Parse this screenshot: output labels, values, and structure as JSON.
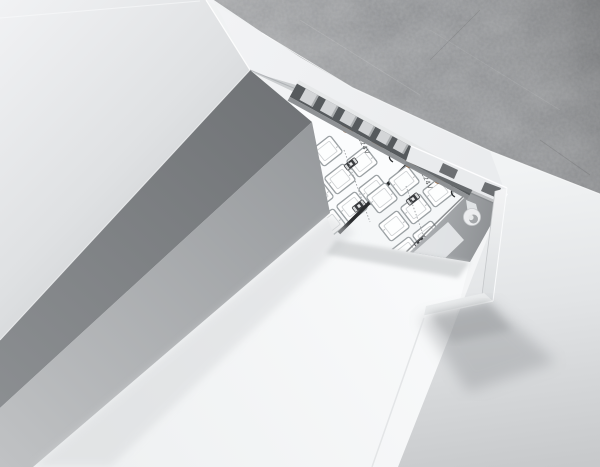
{
  "image": {
    "subject": "Recessed aluminum LED profile with two LED strips, ceiling cutaway render"
  },
  "labels": {
    "strip_voltage": "DC24V",
    "polarity_plus": "+"
  },
  "colors": {
    "concrete": "#85878a",
    "ceiling_light": "#eff1f3",
    "groove_dark_side": "#76797c",
    "profile_outer_side": "#a0a3a6",
    "opening_back": "#cbced0",
    "tooth_light": "#d3d5d7",
    "tooth_gap_dark": "#565a5d",
    "pcb_white": "#fbfcfd",
    "pcb_white_2": "#f5f7f8",
    "copper_pad": "#b4763c",
    "resistor_body": "#3b3d40",
    "resistor_band": "#d8dadb",
    "strip_gap_line": "#2a2c2e",
    "led_outline": "#9aa0a3",
    "cut_face": "#e9ebed",
    "cut_slot_dark": "#6c6f72",
    "cavity_gray": "#a9acaf",
    "diffuser_inner": "#e4e6e8",
    "print_text": "#55585a"
  }
}
